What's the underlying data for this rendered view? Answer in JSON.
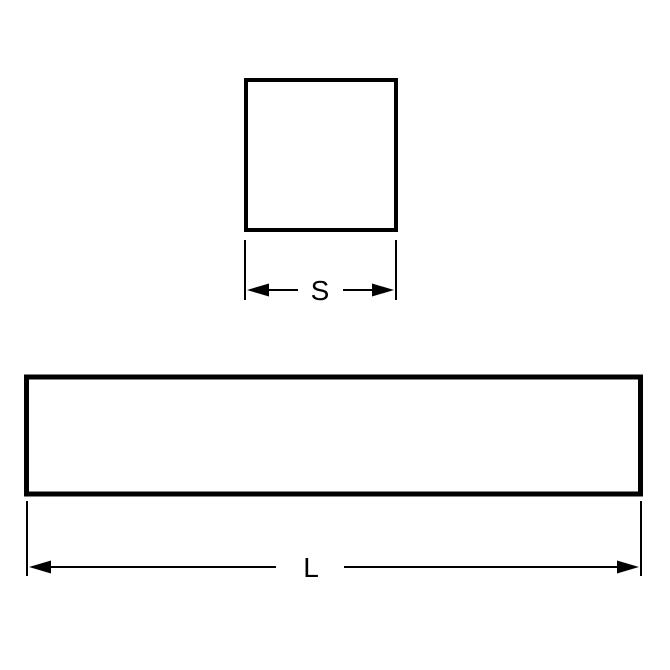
{
  "diagram": {
    "type": "technical-dimension-drawing",
    "background_color": "#ffffff",
    "line_color": "#000000",
    "views": {
      "cross_section": {
        "shape": "square",
        "dimension_label": "S"
      },
      "length_view": {
        "shape": "bar",
        "dimension_label": "L"
      }
    }
  }
}
